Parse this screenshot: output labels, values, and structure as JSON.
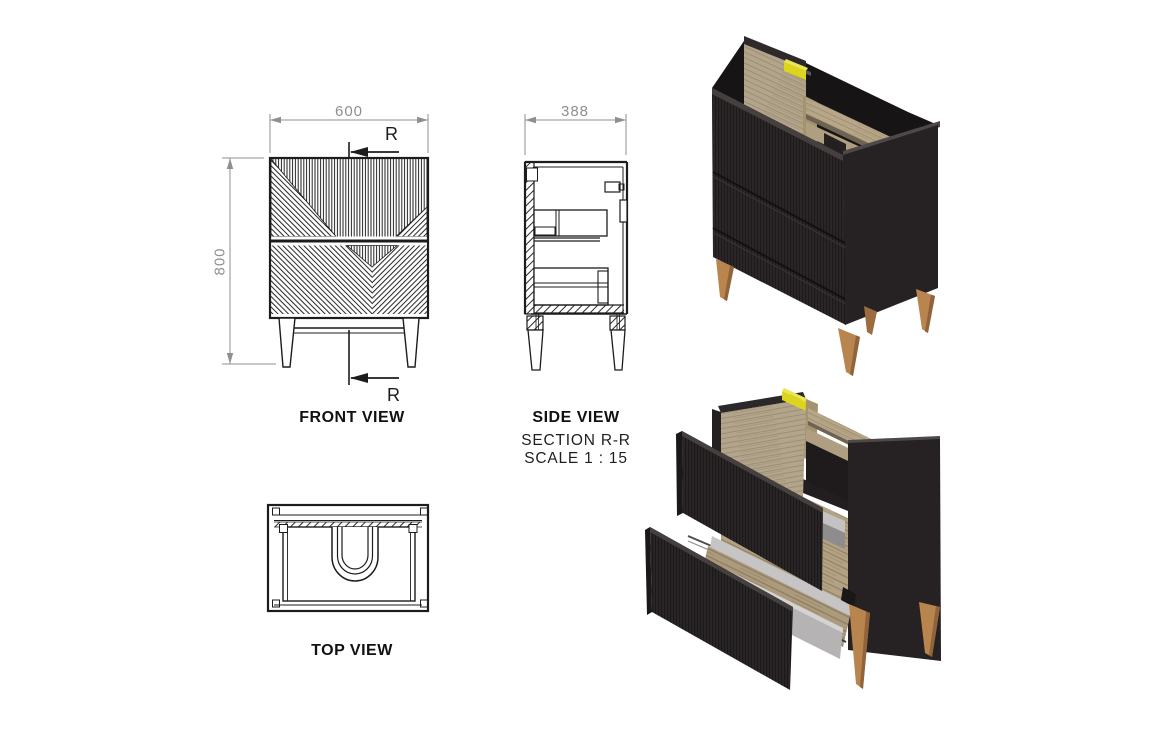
{
  "front_view": {
    "label": "FRONT VIEW",
    "width_dim": "600",
    "height_dim": "800",
    "section_marker": "R"
  },
  "side_view": {
    "label": "SIDE VIEW",
    "width_dim": "388",
    "section_title": "SECTION R-R",
    "scale_note": "SCALE 1 : 15"
  },
  "top_view": {
    "label": "TOP VIEW"
  },
  "colors": {
    "cabinet_black": "#2a2526",
    "wood_panel": "#b2a58b",
    "leg_wood": "#b9854e",
    "fitting_yellow": "#ddd51d",
    "dim_gray": "#8f8f8f",
    "line_black": "#1c1c1c",
    "drawer_tray_gray": "#b5b3b4"
  }
}
